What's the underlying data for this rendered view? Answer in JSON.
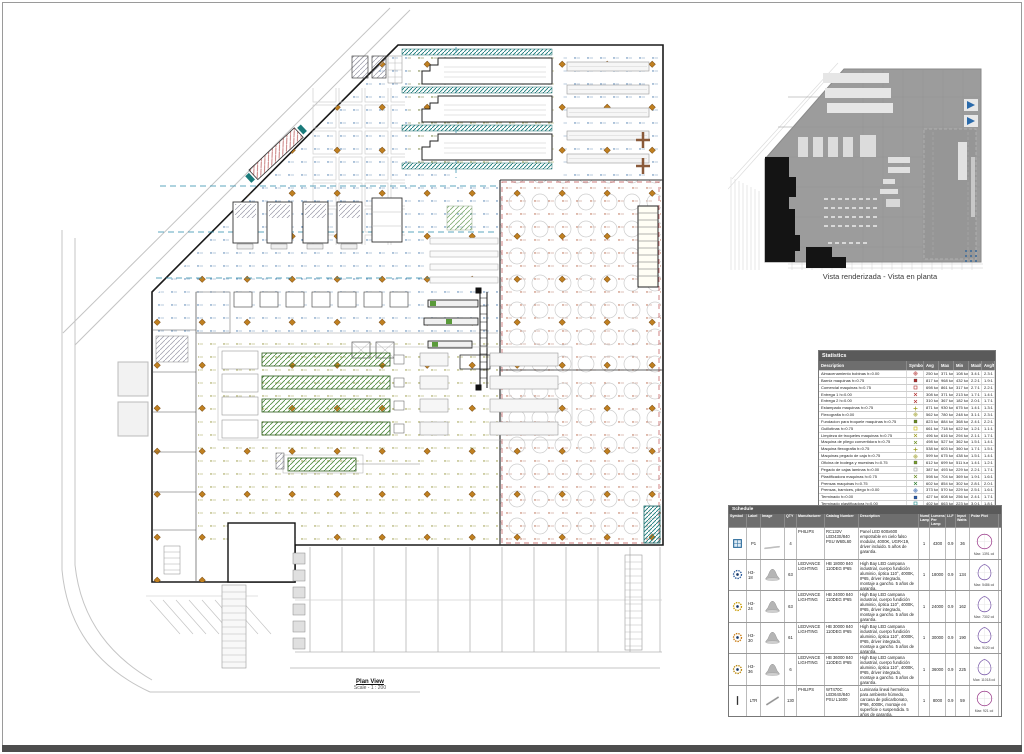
{
  "sheet": {
    "plan_title": "Plan View",
    "plan_scale": "Scale - 1 : 200",
    "render_caption": "Vista renderizada - Vista en planta"
  },
  "colors": {
    "calc_blue": "#3a6ea5",
    "calc_olive": "#8a8a2a",
    "calc_red": "#b05838",
    "luminaire_orange": "#c08020",
    "machine_green": "#4a8a3a",
    "conveyor_teal": "#1a7a7a",
    "header_gray": "#5a5a5a"
  },
  "statistics": {
    "title": "Statistics",
    "headers": [
      "Description",
      "Symbol",
      "Avg",
      "Max",
      "Min",
      "Max/Min",
      "Avg/Min"
    ],
    "rows": [
      {
        "desc": "Almacenamiento bobinas h=0.00",
        "shape": "circle-cross",
        "color": "#b03030",
        "avg": "250 lux",
        "max": "371 lux",
        "min": "108 lux",
        "maxmin": "3.4:1",
        "avgmin": "2.3:1"
      },
      {
        "desc": "Barniz maquinas h=0.75",
        "shape": "square",
        "color": "#b03030",
        "avg": "817 lux",
        "max": "968 lux",
        "min": "432 lux",
        "maxmin": "2.2:1",
        "avgmin": "1.9:1"
      },
      {
        "desc": "Comercial maquinas h=0.75",
        "shape": "square-open",
        "color": "#b03030",
        "avg": "698 lux",
        "max": "861 lux",
        "min": "317 lux",
        "maxmin": "2.7:1",
        "avgmin": "2.2:1"
      },
      {
        "desc": "Entrega 1 h=0.00",
        "shape": "x",
        "color": "#b03030",
        "avg": "308 lux",
        "max": "371 lux",
        "min": "213 lux",
        "maxmin": "1.7:1",
        "avgmin": "1.4:1"
      },
      {
        "desc": "Entrega 2 h=0.00",
        "shape": "x",
        "color": "#b03030",
        "avg": "310 lux",
        "max": "367 lux",
        "min": "182 lux",
        "maxmin": "2.0:1",
        "avgmin": "1.7:1"
      },
      {
        "desc": "Estampado maquinas h=0.75",
        "shape": "plus",
        "color": "#9a9a20",
        "avg": "871 lux",
        "max": "930 lux",
        "min": "675 lux",
        "maxmin": "1.4:1",
        "avgmin": "1.3:1"
      },
      {
        "desc": "Flexografia h=0.00",
        "shape": "circle-cross",
        "color": "#9a9a20",
        "avg": "562 lux",
        "max": "780 lux",
        "min": "248 lux",
        "maxmin": "3.1:1",
        "avgmin": "2.3:1"
      },
      {
        "desc": "Fundacion para troquele maquinas h=0.75",
        "shape": "square",
        "color": "#6b8e23",
        "avg": "823 lux",
        "max": "884 lux",
        "min": "368 lux",
        "maxmin": "2.4:1",
        "avgmin": "2.2:1"
      },
      {
        "desc": "Guillotinas h=0.75",
        "shape": "square-open",
        "color": "#c8b400",
        "avg": "661 lux",
        "max": "718 lux",
        "min": "622 lux",
        "maxmin": "1.2:1",
        "avgmin": "1.1:1"
      },
      {
        "desc": "Limpieza de troqueles maquinas h=0.75",
        "shape": "x",
        "color": "#9a9a20",
        "avg": "496 lux",
        "max": "616 lux",
        "min": "294 lux",
        "maxmin": "2.1:1",
        "avgmin": "1.7:1"
      },
      {
        "desc": "Maquina de pliego convertidora h=0.75",
        "shape": "x",
        "color": "#6b8e23",
        "avg": "498 lux",
        "max": "527 lux",
        "min": "362 lux",
        "maxmin": "1.5:1",
        "avgmin": "1.4:1"
      },
      {
        "desc": "Maquina flexografia h=0.75",
        "shape": "plus",
        "color": "#9a9a20",
        "avg": "538 lux",
        "max": "603 lux",
        "min": "360 lux",
        "maxmin": "1.7:1",
        "avgmin": "1.5:1"
      },
      {
        "desc": "Maquinas pegado de caja h=0.75",
        "shape": "circle-cross",
        "color": "#9a9a20",
        "avg": "599 lux",
        "max": "675 lux",
        "min": "438 lux",
        "maxmin": "1.5:1",
        "avgmin": "1.4:1"
      },
      {
        "desc": "Oficina de bodega y muestras h=0.75",
        "shape": "square",
        "color": "#7aa030",
        "avg": "612 lux",
        "max": "699 lux",
        "min": "511 lux",
        "maxmin": "1.4:1",
        "avgmin": "1.2:1"
      },
      {
        "desc": "Pegado de cajas laminas h=0.00",
        "shape": "square-open",
        "color": "#999999",
        "avg": "387 lux",
        "max": "493 lux",
        "min": "229 lux",
        "maxmin": "2.2:1",
        "avgmin": "1.7:1"
      },
      {
        "desc": "Plastificadora maquinas h=0.75",
        "shape": "x",
        "color": "#6b8e23",
        "avg": "598 lux",
        "max": "704 lux",
        "min": "369 lux",
        "maxmin": "1.9:1",
        "avgmin": "1.6:1"
      },
      {
        "desc": "Prensas maquinas h=0.75",
        "shape": "x",
        "color": "#2e7d32",
        "avg": "602 lux",
        "max": "854 lux",
        "min": "302 lux",
        "maxmin": "2.8:1",
        "avgmin": "2.0:1"
      },
      {
        "desc": "Prensas, barnices, pliego h=0.00",
        "shape": "circle-cross",
        "color": "#2a5caa",
        "avg": "373 lux",
        "max": "570 lux",
        "min": "229 lux",
        "maxmin": "2.5:1",
        "avgmin": "1.6:1"
      },
      {
        "desc": "Terminado h=0.00",
        "shape": "square",
        "color": "#2a5caa",
        "avg": "427 lux",
        "max": "608 lux",
        "min": "256 lux",
        "maxmin": "2.4:1",
        "avgmin": "1.7:1"
      },
      {
        "desc": "Terminado plastificadora h=0.00",
        "shape": "square-open",
        "color": "#1a8a8a",
        "avg": "402 lux",
        "max": "663 lux",
        "min": "223 lux",
        "maxmin": "3.0:1",
        "avgmin": "1.8:1"
      },
      {
        "desc": "Troqueladoras h=0.75",
        "shape": "plus",
        "color": "#b03030",
        "avg": "452 lux",
        "max": "750 lux",
        "min": "250 lux",
        "maxmin": "3.0:1",
        "avgmin": "1.8:1"
      },
      {
        "desc": "Almacen producto terminado h=1.00",
        "shape": "plus",
        "color": "#7a1010",
        "avg": "292 lux",
        "max": "364 lux",
        "min": "157 lux",
        "maxmin": "2.3:1",
        "avgmin": "1.9:1"
      }
    ]
  },
  "schedule": {
    "title": "Schedule",
    "headers": [
      "Symbol",
      "Label",
      "Image",
      "QTY",
      "Manufacturer",
      "Catalog Number",
      "Description",
      "Number Lamps",
      "Lumens Per Lamp",
      "LLF",
      "Input Watts",
      "Polar Plot"
    ],
    "rows": [
      {
        "shape": "panel",
        "ringColor": "#2a6a9a",
        "label": "P1",
        "image": "panel",
        "qty": "4",
        "manufacturer": "PHILIPS",
        "catalog": "RC132V LED43S/840 PSU W60L60",
        "description": "Panel LED 600x600 empotrable en cielo falso modular, 4000K, UGR<19, driver incluido. 5 años de garantía.",
        "lamps": "1",
        "lumens": "4300",
        "llf": "0.9",
        "watts": "36",
        "polar": "circle",
        "polarMax": "Max: 1391 cd"
      },
      {
        "shape": "circle-dot",
        "ringColor": "#2a5a9a",
        "label": "H3-18",
        "image": "highbay",
        "qty": "63",
        "manufacturer": "LEDVANCE LIGHTING",
        "catalog": "HB 18000 840 110DEG IP65",
        "description": "High Bay LED campana industrial, cuerpo fundición aluminio, óptica 110°, 4000K, IP65, driver integrado, montaje a gancho. 5 años de garantía.",
        "lamps": "1",
        "lumens": "18000",
        "llf": "0.9",
        "watts": "134",
        "polar": "teardrop",
        "polarMax": "Max: 5486 cd"
      },
      {
        "shape": "circle-dot",
        "ringColor": "#c89a00",
        "label": "H3-24",
        "image": "highbay",
        "qty": "63",
        "manufacturer": "LEDVANCE LIGHTING",
        "catalog": "HB 24000 840 110DEG IP65",
        "description": "High Bay LED campana industrial, cuerpo fundición aluminio, óptica 110°, 4000K, IP65, driver integrado, montaje a gancho. 5 años de garantía.",
        "lamps": "1",
        "lumens": "24000",
        "llf": "0.9",
        "watts": "162",
        "polar": "teardrop",
        "polarMax": "Max: 7302 cd"
      },
      {
        "shape": "circle-dot",
        "ringColor": "#c87a10",
        "label": "H3-30",
        "image": "highbay",
        "qty": "61",
        "manufacturer": "LEDVANCE LIGHTING",
        "catalog": "HB 30000 840 110DEG IP65",
        "description": "High Bay LED campana industrial, cuerpo fundición aluminio, óptica 110°, 4000K, IP65, driver integrado, montaje a gancho. 5 años de garantía.",
        "lamps": "1",
        "lumens": "30000",
        "llf": "0.9",
        "watts": "190",
        "polar": "teardrop",
        "polarMax": "Max: 9120 cd"
      },
      {
        "shape": "circle-dot",
        "ringColor": "#b8860b",
        "label": "H3-36",
        "image": "highbay",
        "qty": "6",
        "manufacturer": "LEDVANCE LIGHTING",
        "catalog": "HB 36000 840 110DEG IP65",
        "description": "High Bay LED campana industrial, cuerpo fundición aluminio, óptica 110°, 4000K, IP65, driver integrado, montaje a gancho. 5 años de garantía.",
        "lamps": "1",
        "lumens": "36000",
        "llf": "0.9",
        "watts": "225",
        "polar": "teardrop",
        "polarMax": "Max: 11018 cd"
      },
      {
        "shape": "bar",
        "ringColor": "#444444",
        "label": "LTR",
        "image": "strip",
        "qty": "130",
        "manufacturer": "PHILIPS",
        "catalog": "WT470C LED64S/840 PSU L1600",
        "description": "Luminaria lineal hermética para ambiente húmedo, carcasa de policarbonato, IP66, 4000K, montaje en superficie o suspendida. 5 años de garantía.",
        "lamps": "1",
        "lumens": "8000",
        "llf": "0.9",
        "watts": "59",
        "polar": "circle",
        "polarMax": "Max: 921 cd"
      }
    ]
  }
}
